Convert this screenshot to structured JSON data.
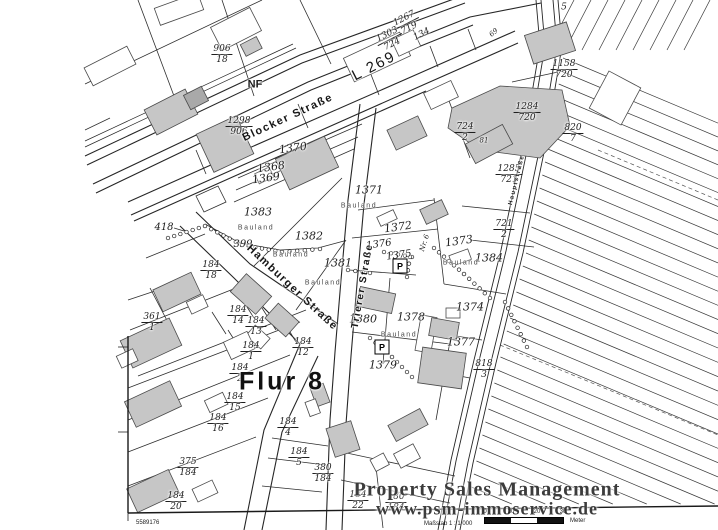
{
  "map": {
    "sheet_number": "5589176",
    "flur_label": "Flur 8",
    "bauland_text": "Bauland",
    "parking_letter": "P",
    "watermark": {
      "line1": "Property Sales Management",
      "line2": "www.psm-immoservice.de"
    },
    "scale": {
      "text": "Maßstab 1 : 1 000",
      "ticks": [
        "0",
        "10",
        "20",
        "30"
      ],
      "unit": "Meter"
    },
    "streets": [
      {
        "name": "Blocker Straße",
        "x": 288,
        "y": 118,
        "rot": -25,
        "size": 11
      },
      {
        "name": "L 269",
        "x": 374,
        "y": 66,
        "rot": -27,
        "size": 15
      },
      {
        "name": "Hamburger Straße",
        "x": 292,
        "y": 288,
        "rot": 43,
        "size": 11
      },
      {
        "name": "Trierer Straße",
        "x": 363,
        "y": 286,
        "rot": -80,
        "size": 10
      },
      {
        "name": "Hauptstraße",
        "x": 517,
        "y": 180,
        "rot": -76,
        "size": 6
      }
    ],
    "fraction_labels": [
      {
        "t": "906/18",
        "x": 222,
        "y": 55
      },
      {
        "t": "1298/906",
        "x": 239,
        "y": 127
      },
      {
        "t": "1267/719",
        "x": 407,
        "y": 24,
        "r": -27
      },
      {
        "t": "1303/724",
        "x": 390,
        "y": 40,
        "r": -27
      },
      {
        "t": "1158/720",
        "x": 564,
        "y": 70
      },
      {
        "t": "1284/720",
        "x": 527,
        "y": 113
      },
      {
        "t": "724/2",
        "x": 465,
        "y": 133
      },
      {
        "t": "820/7",
        "x": 573,
        "y": 134
      },
      {
        "t": "1285/721",
        "x": 509,
        "y": 175
      },
      {
        "t": "721/2",
        "x": 504,
        "y": 230
      },
      {
        "t": "818/3",
        "x": 484,
        "y": 370
      },
      {
        "t": "361/1",
        "x": 152,
        "y": 323
      },
      {
        "t": "184/18",
        "x": 211,
        "y": 271
      },
      {
        "t": "184/14",
        "x": 238,
        "y": 316
      },
      {
        "t": "184/13",
        "x": 256,
        "y": 327
      },
      {
        "t": "184/12",
        "x": 303,
        "y": 348
      },
      {
        "t": "184/1",
        "x": 251,
        "y": 352
      },
      {
        "t": "184/2",
        "x": 240,
        "y": 374
      },
      {
        "t": "184/15",
        "x": 235,
        "y": 403
      },
      {
        "t": "184/16",
        "x": 218,
        "y": 424
      },
      {
        "t": "375/184",
        "x": 188,
        "y": 468
      },
      {
        "t": "184/20",
        "x": 176,
        "y": 502
      },
      {
        "t": "184/4",
        "x": 288,
        "y": 428
      },
      {
        "t": "184/5",
        "x": 299,
        "y": 458
      },
      {
        "t": "380/184",
        "x": 323,
        "y": 474
      },
      {
        "t": "184/22",
        "x": 358,
        "y": 501
      },
      {
        "t": "180/184",
        "x": 396,
        "y": 503
      }
    ],
    "plain_labels": [
      {
        "t": "1370",
        "x": 293,
        "y": 148,
        "r": -8
      },
      {
        "t": "1368",
        "x": 271,
        "y": 167,
        "r": -8
      },
      {
        "t": "1369",
        "x": 266,
        "y": 178,
        "r": -8
      },
      {
        "t": "1371",
        "x": 369,
        "y": 190
      },
      {
        "t": "1372",
        "x": 398,
        "y": 227,
        "r": -8
      },
      {
        "t": "1373",
        "x": 459,
        "y": 241,
        "r": -8
      },
      {
        "t": "1384",
        "x": 489,
        "y": 258
      },
      {
        "t": "1376",
        "x": 379,
        "y": 245,
        "r": -8,
        "s": 10
      },
      {
        "t": "1375",
        "x": 399,
        "y": 256,
        "r": -8,
        "s": 10
      },
      {
        "t": "1383",
        "x": 258,
        "y": 212
      },
      {
        "t": "1382",
        "x": 309,
        "y": 236
      },
      {
        "t": "1381",
        "x": 338,
        "y": 263
      },
      {
        "t": "1380",
        "x": 363,
        "y": 319
      },
      {
        "t": "1378",
        "x": 411,
        "y": 317
      },
      {
        "t": "1379",
        "x": 383,
        "y": 365
      },
      {
        "t": "1374",
        "x": 470,
        "y": 307
      },
      {
        "t": "1377",
        "x": 461,
        "y": 342
      },
      {
        "t": "418",
        "x": 164,
        "y": 228,
        "s": 10
      },
      {
        "t": "399",
        "x": 243,
        "y": 245,
        "s": 10
      },
      {
        "t": "134",
        "x": 422,
        "y": 35,
        "r": -27,
        "s": 9
      },
      {
        "t": "5",
        "x": 564,
        "y": 8,
        "s": 9
      },
      {
        "t": "NF",
        "x": 255,
        "y": 85,
        "s": 11,
        "b": true
      }
    ],
    "house_numbers": [
      {
        "t": "69",
        "x": 494,
        "y": 33,
        "r": -40
      },
      {
        "t": "81",
        "x": 484,
        "y": 141
      },
      {
        "t": "Nr. 6",
        "x": 425,
        "y": 243,
        "r": -72
      }
    ],
    "bauland_positions": [
      {
        "x": 359,
        "y": 206
      },
      {
        "x": 256,
        "y": 228
      },
      {
        "x": 291,
        "y": 255
      },
      {
        "x": 323,
        "y": 283
      },
      {
        "x": 461,
        "y": 263
      },
      {
        "x": 399,
        "y": 335
      }
    ],
    "parking_signs": [
      {
        "x": 400,
        "y": 266
      },
      {
        "x": 382,
        "y": 347
      }
    ],
    "colors": {
      "line": "#2e2e2e",
      "building_gray": "#c6c6c6",
      "building_dark": "#a9a9a9"
    }
  }
}
